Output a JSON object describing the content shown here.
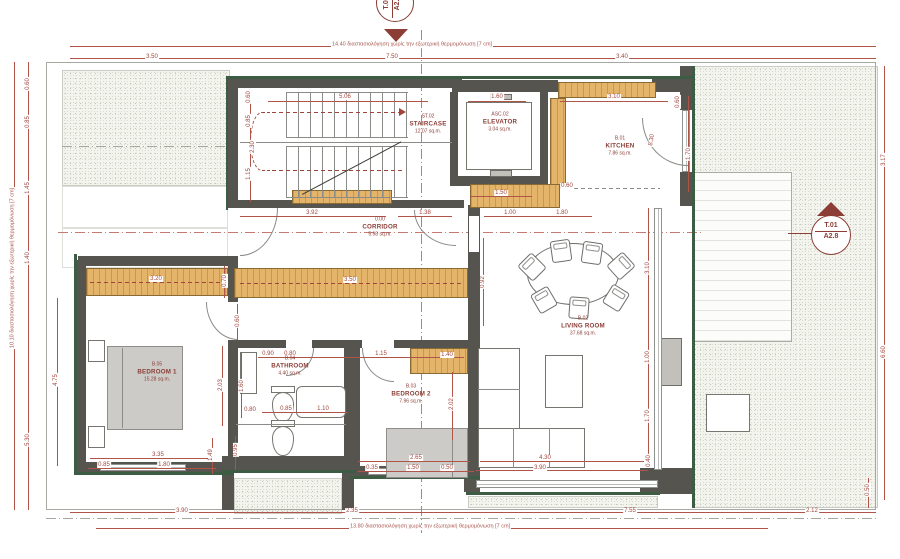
{
  "markers": {
    "right": {
      "label": "T.01",
      "sheet": "A2.8"
    },
    "top": {
      "label": "T.02",
      "sheet": "A2.8"
    }
  },
  "rooms": [
    {
      "code": "ST.02",
      "name": "STAIRCASE",
      "area": "12.07 sq.m.",
      "x": 428,
      "y": 124
    },
    {
      "code": "ASC.02",
      "name": "ELEVATOR",
      "area": "3.04 sq.m.",
      "x": 500,
      "y": 122
    },
    {
      "code": "B.01",
      "name": "KITCHEN",
      "area": "7.86 sq.m.",
      "x": 620,
      "y": 146
    },
    {
      "code": "0.00",
      "name": "CORRIDOR",
      "area": "5.98 sq.m.",
      "x": 380,
      "y": 227
    },
    {
      "code": "B.05",
      "name": "BEDROOM 1",
      "area": "15.28 sq.m.",
      "x": 157,
      "y": 372
    },
    {
      "code": "B.04",
      "name": "BATHROOM",
      "area": "4.40 sq.m.",
      "x": 290,
      "y": 366
    },
    {
      "code": "B.03",
      "name": "BEDROOM 2",
      "area": "7.96 sq.m.",
      "x": 411,
      "y": 394
    },
    {
      "code": "B.02",
      "name": "LIVING ROOM",
      "area": "37.68 sq.m.",
      "x": 583,
      "y": 326
    }
  ],
  "dimensions": [
    {
      "t": "3.50",
      "x": 152,
      "y": 57
    },
    {
      "t": "7.50",
      "x": 392,
      "y": 57
    },
    {
      "t": "3.40",
      "x": 622,
      "y": 57
    },
    {
      "t": "14.40 διαστασιολόγηση χωρίς την εξωτερική θερμομόνωση [7 cm]",
      "x": 412,
      "y": 45,
      "c": "note"
    },
    {
      "t": "3.90",
      "x": 182,
      "y": 511
    },
    {
      "t": "2.35",
      "x": 352,
      "y": 511
    },
    {
      "t": "7.55",
      "x": 630,
      "y": 511
    },
    {
      "t": "2.12",
      "x": 812,
      "y": 511
    },
    {
      "t": "13.80 διαστασιολόγηση χωρίς την εξωτερική θερμομόνωση [7 cm]",
      "x": 430,
      "y": 527,
      "c": "note"
    },
    {
      "t": "0.60",
      "x": 28,
      "y": 84,
      "r": -90
    },
    {
      "t": "0.85",
      "x": 28,
      "y": 122,
      "r": -90
    },
    {
      "t": "1.45",
      "x": 28,
      "y": 188,
      "r": -90
    },
    {
      "t": "1.40",
      "x": 28,
      "y": 258,
      "r": -90
    },
    {
      "t": "5.30",
      "x": 28,
      "y": 440,
      "r": -90
    },
    {
      "t": "10.10 διαστασιολόγηση χωρίς την εξωτερική θερμομόνωση [7 cm]",
      "x": 13,
      "y": 268,
      "r": -90,
      "c": "note"
    },
    {
      "t": "3.17",
      "x": 884,
      "y": 160,
      "r": -90
    },
    {
      "t": "6.60",
      "x": 884,
      "y": 352,
      "r": -90
    },
    {
      "t": "0.50",
      "x": 868,
      "y": 490,
      "r": -90
    },
    {
      "t": "5.06",
      "x": 345,
      "y": 97
    },
    {
      "t": "0.60",
      "x": 249,
      "y": 97,
      "r": -90
    },
    {
      "t": "0.85",
      "x": 249,
      "y": 121,
      "r": -90
    },
    {
      "t": "2.30",
      "x": 253,
      "y": 147,
      "r": -90
    },
    {
      "t": "1.15",
      "x": 249,
      "y": 174,
      "r": -90
    },
    {
      "t": "1.60",
      "x": 497,
      "y": 97
    },
    {
      "t": "3.10",
      "x": 614,
      "y": 97
    },
    {
      "t": "0.60",
      "x": 678,
      "y": 102,
      "r": -90
    },
    {
      "t": "8.30",
      "x": 652,
      "y": 140,
      "r": -80
    },
    {
      "t": "1.70",
      "x": 689,
      "y": 154,
      "r": -90
    },
    {
      "t": "0.60",
      "x": 567,
      "y": 186
    },
    {
      "t": "1.50",
      "x": 501,
      "y": 193
    },
    {
      "t": "3.92",
      "x": 312,
      "y": 213
    },
    {
      "t": "1.38",
      "x": 425,
      "y": 213
    },
    {
      "t": "1.00",
      "x": 510,
      "y": 213
    },
    {
      "t": "1.80",
      "x": 562,
      "y": 213
    },
    {
      "t": "3.50",
      "x": 350,
      "y": 280
    },
    {
      "t": "3.20",
      "x": 156,
      "y": 279
    },
    {
      "t": "0.70",
      "x": 225,
      "y": 281,
      "r": -90
    },
    {
      "t": "0.60",
      "x": 238,
      "y": 321,
      "r": -90
    },
    {
      "t": "4.75",
      "x": 56,
      "y": 380,
      "r": -90
    },
    {
      "t": "2.03",
      "x": 221,
      "y": 385,
      "r": -90
    },
    {
      "t": "1.60",
      "x": 242,
      "y": 386,
      "r": -90
    },
    {
      "t": "0.80",
      "x": 250,
      "y": 410
    },
    {
      "t": "3.35",
      "x": 158,
      "y": 455
    },
    {
      "t": "0.85",
      "x": 104,
      "y": 465
    },
    {
      "t": "1.80",
      "x": 164,
      "y": 465
    },
    {
      "t": "1.49",
      "x": 211,
      "y": 455,
      "r": -90
    },
    {
      "t": "0.95",
      "x": 236,
      "y": 450,
      "r": -90
    },
    {
      "t": "0.90",
      "x": 268,
      "y": 354
    },
    {
      "t": "0.80",
      "x": 290,
      "y": 354
    },
    {
      "t": "0.85",
      "x": 286,
      "y": 409
    },
    {
      "t": "1.10",
      "x": 323,
      "y": 409
    },
    {
      "t": "1.15",
      "x": 381,
      "y": 354
    },
    {
      "t": "1.40",
      "x": 447,
      "y": 355
    },
    {
      "t": "2.02",
      "x": 452,
      "y": 404,
      "r": -90
    },
    {
      "t": "2.65",
      "x": 416,
      "y": 458
    },
    {
      "t": "0.35",
      "x": 372,
      "y": 468
    },
    {
      "t": "1.50",
      "x": 413,
      "y": 468
    },
    {
      "t": "0.50",
      "x": 447,
      "y": 468
    },
    {
      "t": "0.92",
      "x": 483,
      "y": 282,
      "r": -90
    },
    {
      "t": "3.10",
      "x": 648,
      "y": 268,
      "r": -90
    },
    {
      "t": "1.00",
      "x": 648,
      "y": 357,
      "r": -90
    },
    {
      "t": "1.70",
      "x": 648,
      "y": 416,
      "r": -90
    },
    {
      "t": "0.40",
      "x": 649,
      "y": 461,
      "r": -90
    },
    {
      "t": "4.30",
      "x": 545,
      "y": 458
    },
    {
      "t": "3.90",
      "x": 540,
      "y": 468
    }
  ]
}
